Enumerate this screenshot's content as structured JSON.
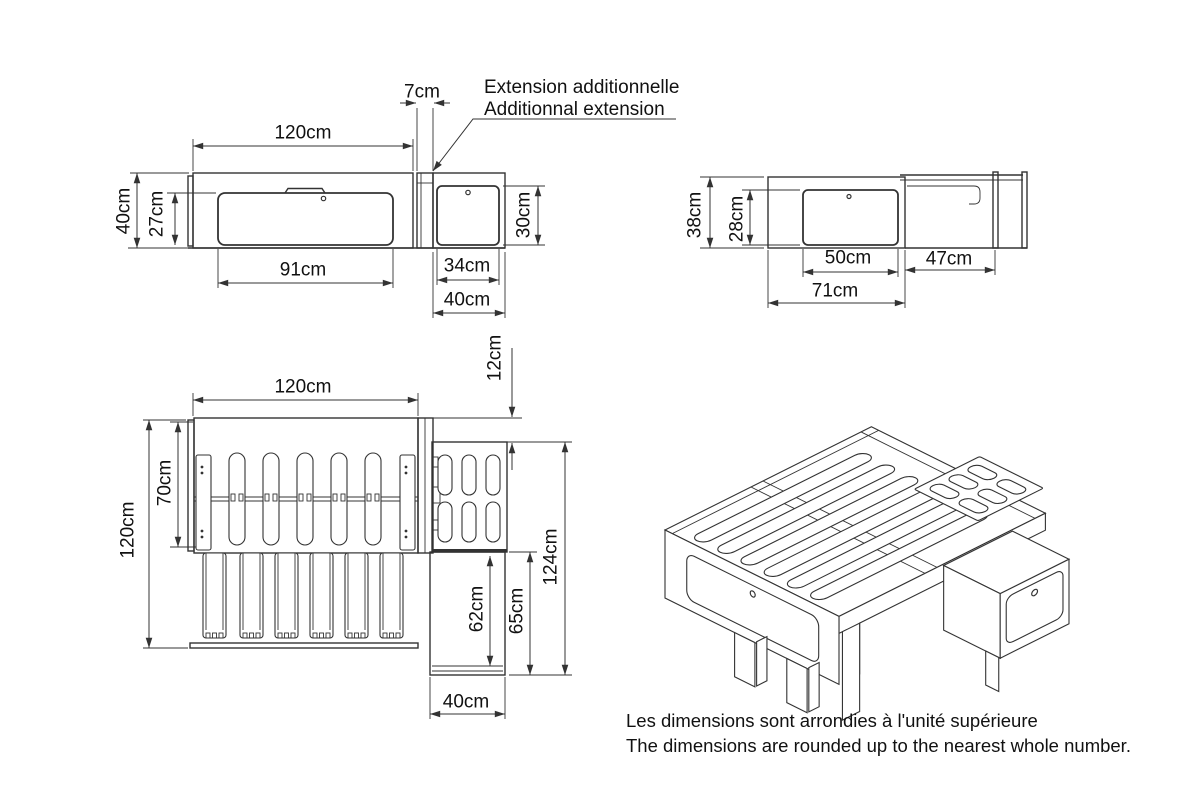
{
  "front_view": {
    "dims": {
      "overall_width": "120cm",
      "extension_width": "7cm",
      "overall_height": "40cm",
      "panel_height": "27cm",
      "panel_width": "91cm",
      "box_panel_width": "34cm",
      "box_panel_height": "30cm",
      "box_width": "40cm"
    },
    "callout": {
      "fr": "Extension additionnelle",
      "en": "Additionnal extension"
    }
  },
  "side_view": {
    "dims": {
      "overall_height": "38cm",
      "panel_height": "28cm",
      "panel_width": "50cm",
      "extension_length": "47cm",
      "base_length": "71cm"
    }
  },
  "top_view": {
    "dims": {
      "overall_width": "120cm",
      "overall_depth": "120cm",
      "slat_section": "70cm",
      "top_offset": "12cm",
      "total_depth": "124cm",
      "box_inner_depth": "62cm",
      "box_outer_depth": "65cm",
      "box_width": "40cm"
    }
  },
  "footer": {
    "fr": "Les dimensions sont arrondies à l'unité supérieure",
    "en": "The dimensions are rounded up to the nearest whole number."
  },
  "colors": {
    "line": "#333333",
    "text": "#111111",
    "background": "#ffffff"
  }
}
